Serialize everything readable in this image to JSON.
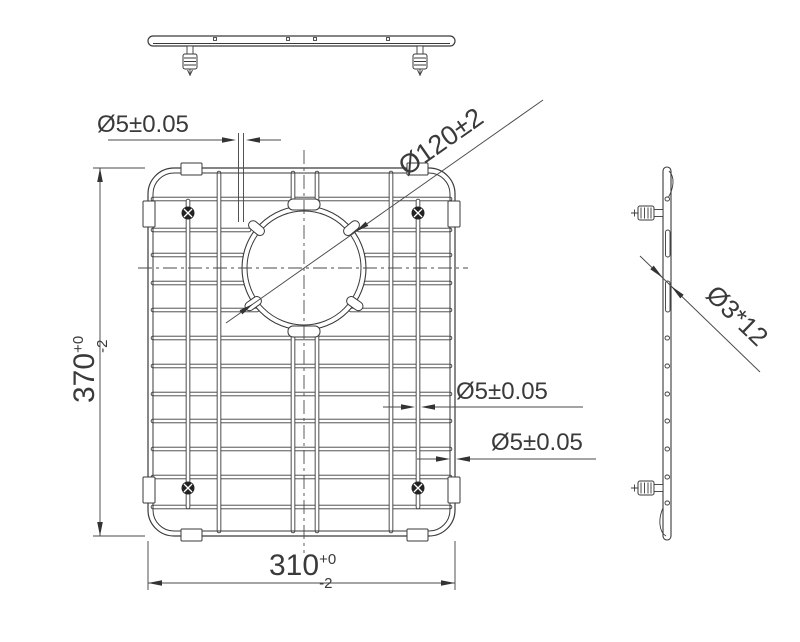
{
  "drawing": {
    "callouts": {
      "wire_top": "Ø5±0.05",
      "hole_diameter": "Ø120±2",
      "wire_mid": "Ø5±0.05",
      "wire_frame": "Ø5±0.05",
      "side_feet": "Ø3*12"
    },
    "dims": {
      "height": {
        "value": "370",
        "tol_plus": "+0",
        "tol_minus": "-2"
      },
      "width": {
        "value": "310",
        "tol_plus": "+0",
        "tol_minus": "-2"
      }
    },
    "colors": {
      "line": "#3a3a3a",
      "dimension": "#4a4a4a",
      "background": "#ffffff"
    }
  }
}
